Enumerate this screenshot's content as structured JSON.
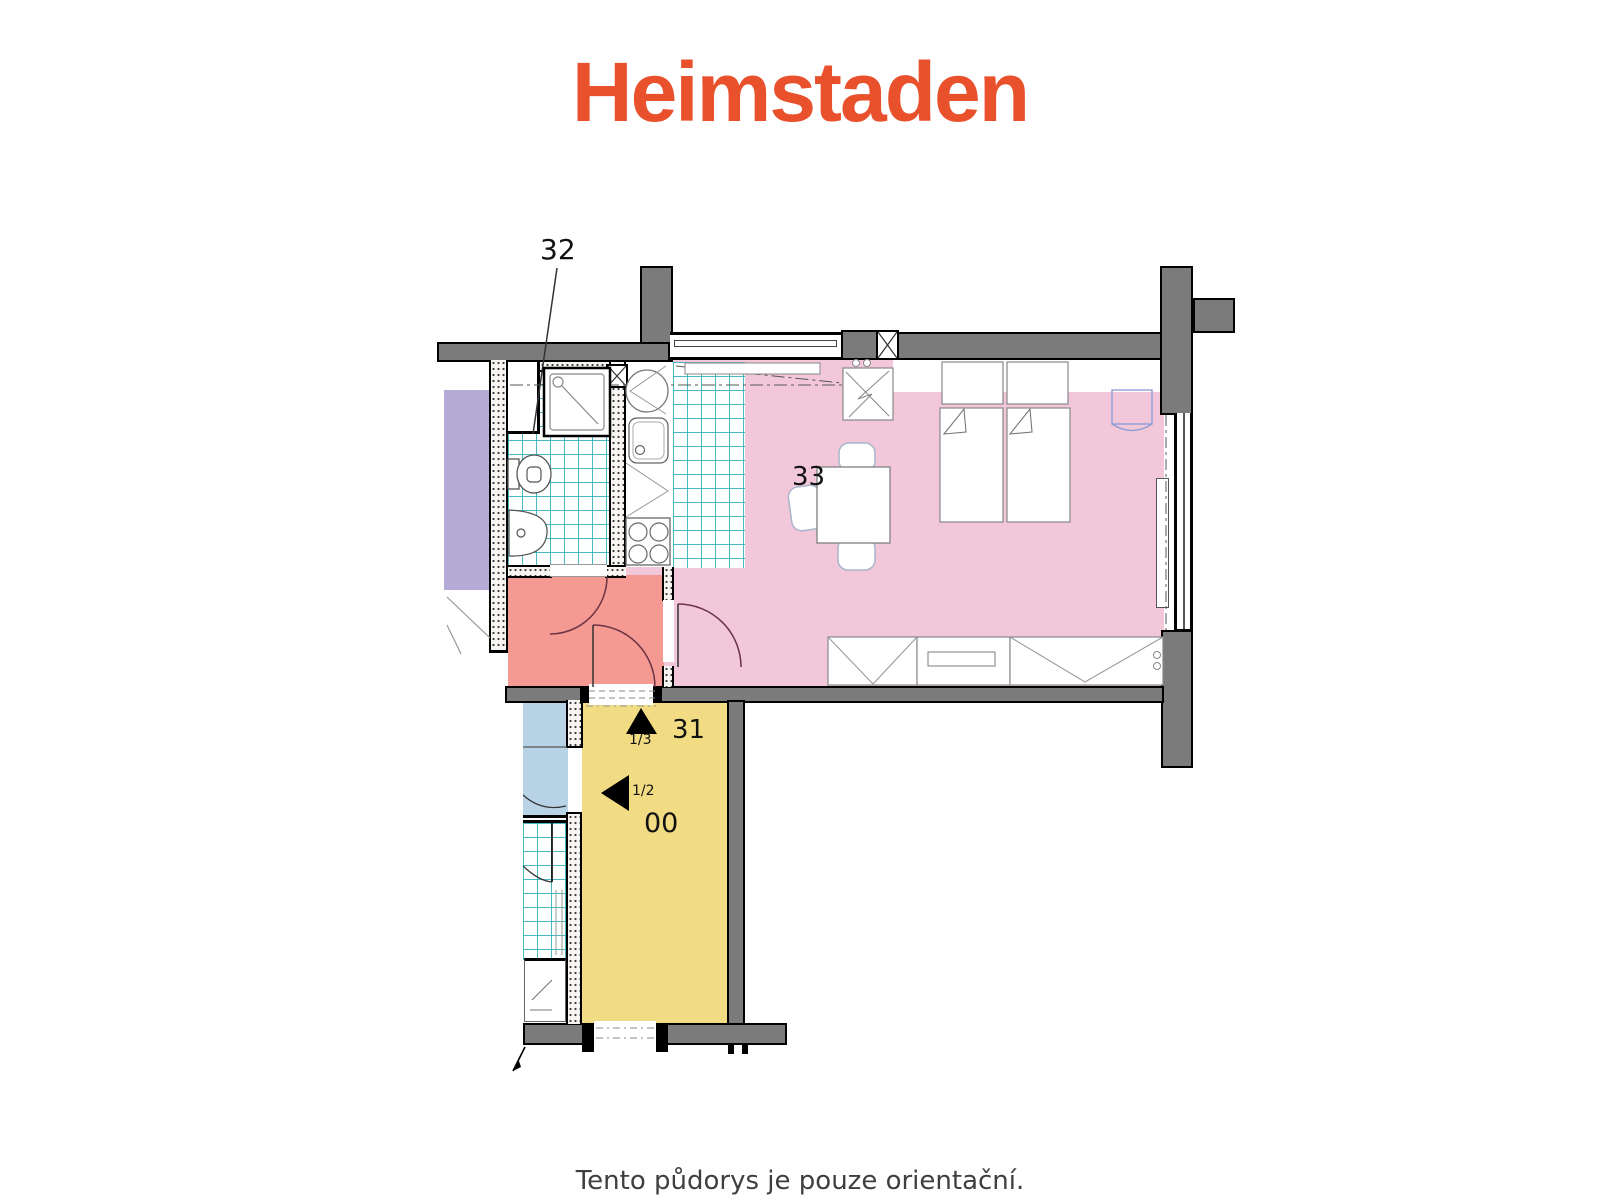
{
  "logo": {
    "text": "Heimstaden",
    "color": "#e8512c"
  },
  "caption": {
    "text": "Tento půdorys je pouze orientační."
  },
  "plan": {
    "labels": {
      "bathroom": "32",
      "living_room": "33",
      "staircase": "31",
      "landing": "00",
      "stair_up": "1/3",
      "stair_half": "1/2"
    },
    "colors": {
      "wall": "#7b7b7b",
      "living_room_fill": "#f2c7da",
      "hallway_fill": "#f59a92",
      "staircase_fill": "#f2dc83",
      "neighbor_bath_fill": "#b9d3e6",
      "neighbor_flat_fill": "#b6aad6",
      "tile_line": "#2fb3b8",
      "door_arc": "#6d3344"
    }
  }
}
